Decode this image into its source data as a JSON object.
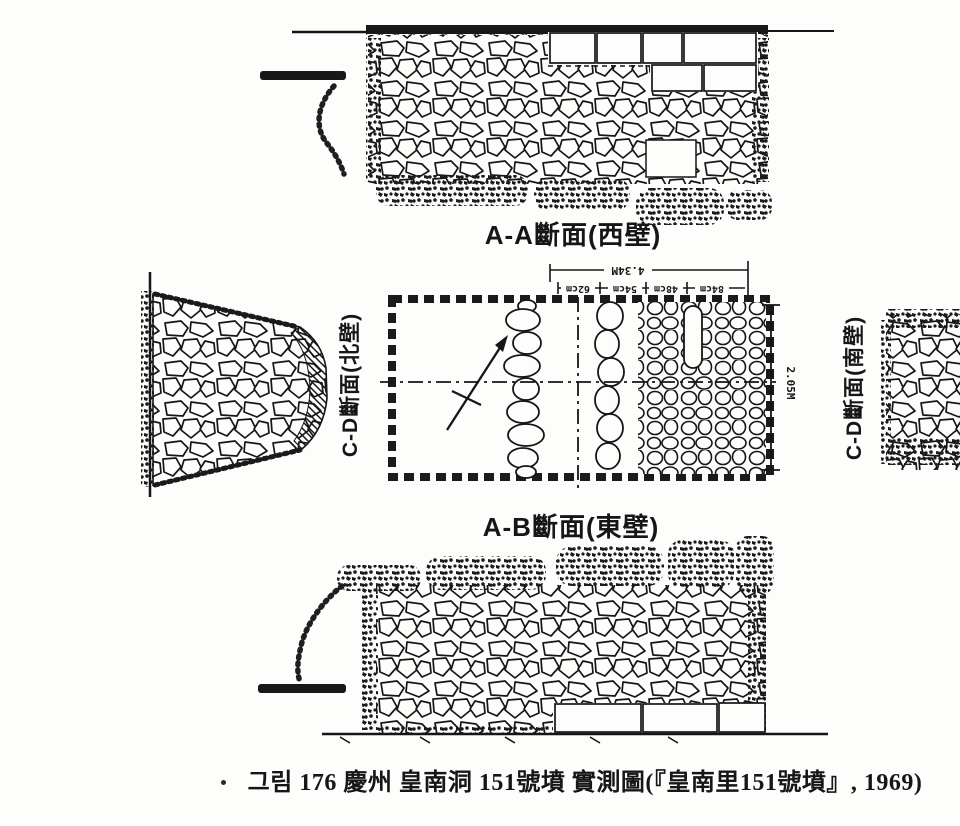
{
  "page": {
    "type": "scanned book figure page",
    "paper_color": "#fdfdfb",
    "ink_color": "#161616"
  },
  "figure": {
    "caption": "그림 176  慶州 皇南洞 151號墳 實測圖(『皇南里151號墳』, 1969)",
    "section_labels": {
      "west_wall": "A-A斷面(西壁)",
      "east_wall": "A-B斷面(東壁)",
      "north_wall": "C-D斷面(北壁)",
      "south_wall": "C-D斷面(南壁)"
    },
    "dimensions": {
      "total_width": "4.34M",
      "height": "2.05M",
      "segments": [
        "62cm",
        "54cm",
        "48cm",
        "84cm"
      ]
    }
  }
}
